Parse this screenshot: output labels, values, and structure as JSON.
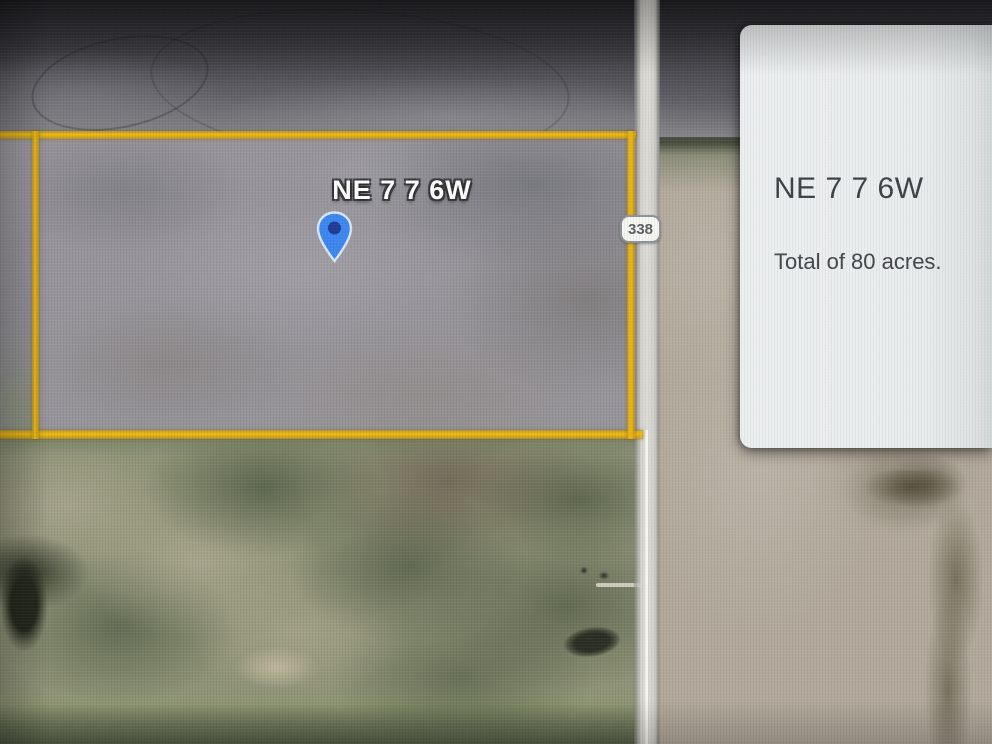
{
  "map": {
    "parcel_label": "NE 7 7 6W",
    "road_badge_label": "338",
    "colors": {
      "parcel_outline": "#E9B512",
      "marker_fill": "#3D87F0",
      "marker_dot": "#1D3D96",
      "marker_border": "#D9E9FB"
    }
  },
  "info_card": {
    "title": "NE 7 7 6W",
    "subtitle": "Total of 80 acres."
  }
}
